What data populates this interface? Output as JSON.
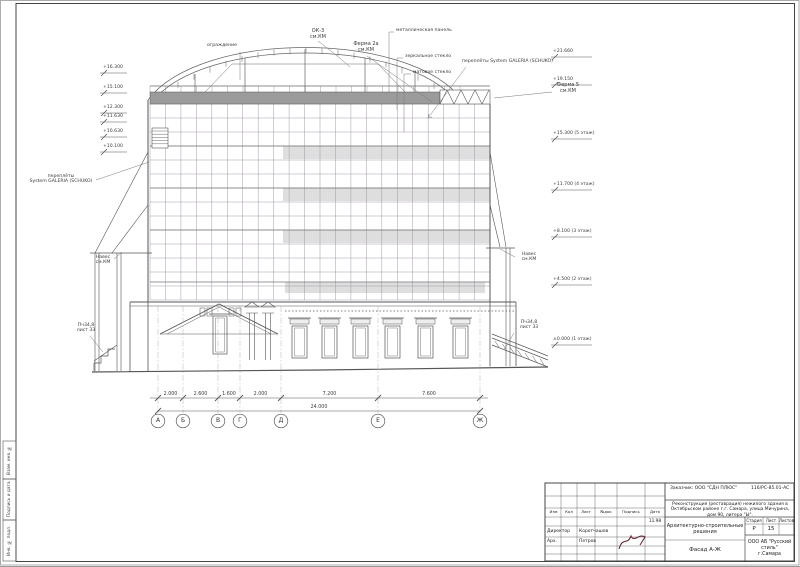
{
  "annotations": {
    "railing": "ограждение",
    "ok3": "ОК-3\nсм.КМ",
    "truss2a": "Ферма 2а\nсм.КМ",
    "metal_panel": "металлическая панель",
    "mirror_glass": "зеркальное стекло",
    "matte_glass": "матовое стекло",
    "glazing_right": "переплёты System GALERIA (SCHUKO)",
    "truss5": "Ферма 5\nсм.КМ",
    "glazing_left": "переплёты\nSystem GALERIA (SCHUKO)",
    "canopy_left": "Навес\nсм.КМ",
    "canopy_right": "Навес\nсм.КМ",
    "stair_left": "Пч34,8\nлист 33",
    "stair_right": "Пч34,8\nлист 33"
  },
  "elevations": {
    "left": [
      "+16.300",
      "+15.100",
      "+12.300",
      "+11.630",
      "+10.630",
      "+10.100"
    ],
    "right": [
      "+21.660",
      "+19.150",
      "+15.300 (5 этаж)",
      "+11.700 (4 этаж)",
      "+8.100 (3 этаж)",
      "+4.500 (2 этаж)",
      "±0.000 (1 этаж)"
    ]
  },
  "dimensions": {
    "segments": [
      "2.000",
      "2.600",
      "1.600",
      "2.000",
      "7.200",
      "7.600"
    ],
    "total": "24.000"
  },
  "axes": [
    "А",
    "Б",
    "В",
    "Г",
    "Д",
    "Е",
    "Ж"
  ],
  "titleblock": {
    "customer": "Заказчик: ООО \"СДН ПЛЮС\"",
    "code": "116/РС-85.01-АС",
    "project": "Реконструкция (реставрация) нежилого здания в Октябрьском районе г.г. Самара, улица Мичурина, дом 90, литера \"Ы\".",
    "section": "Архитектурно-строительные решения",
    "stage_label": "Стадия",
    "sheet_label": "Лист",
    "sheets_label": "Листов",
    "stage": "Р",
    "sheet": "15",
    "sheets": "",
    "drawing_title": "Фасад А-Ж",
    "firm": "ООО АБ \"Русский стиль\"",
    "city": "г.Самара",
    "cols": [
      "Изм",
      "Кол",
      "Лист",
      "№док",
      "Подпись",
      "Дата"
    ],
    "date": "11.98",
    "roles": [
      {
        "role": "Директор",
        "name": "Коротчашов"
      },
      {
        "role": "Арх.",
        "name": "Петров"
      }
    ]
  },
  "stamps": [
    "Взам. инв. №",
    "Подпись и дата",
    "Инв. № подл."
  ]
}
